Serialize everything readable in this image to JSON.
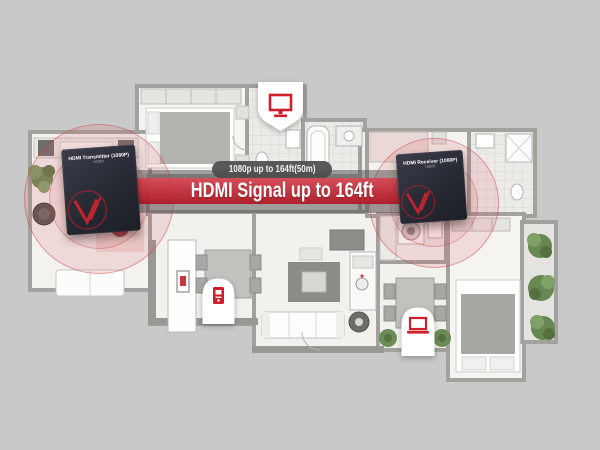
{
  "scene": {
    "description": "Apartment floor plan illustrating HDMI extender signal range",
    "background_color": "#c9c9c9"
  },
  "banner": {
    "range_label": "1080p up to 164ft(50m)",
    "headline": "HDMI Signal up to 164ft",
    "banner_red": "#c22a39",
    "pill_gray": "#4e4e4e"
  },
  "devices": {
    "transmitter": {
      "name": "HDMI Transmitter (1080P)",
      "model": "HDbitT",
      "logo": "V"
    },
    "receiver": {
      "name": "HDMI Receiver (1080P)",
      "model": "HDbitT",
      "logo": "V"
    }
  },
  "badges": [
    {
      "id": "tv",
      "icon": "tv-icon"
    },
    {
      "id": "media-player",
      "icon": "media-player-icon"
    },
    {
      "id": "laptop",
      "icon": "laptop-icon"
    }
  ],
  "colors": {
    "icon_red": "#cf1f2c",
    "signal_ring_red": "#c0303c",
    "device_dark": "#272933",
    "badge_white": "#ffffff",
    "wall_gray": "#a3a19d"
  }
}
